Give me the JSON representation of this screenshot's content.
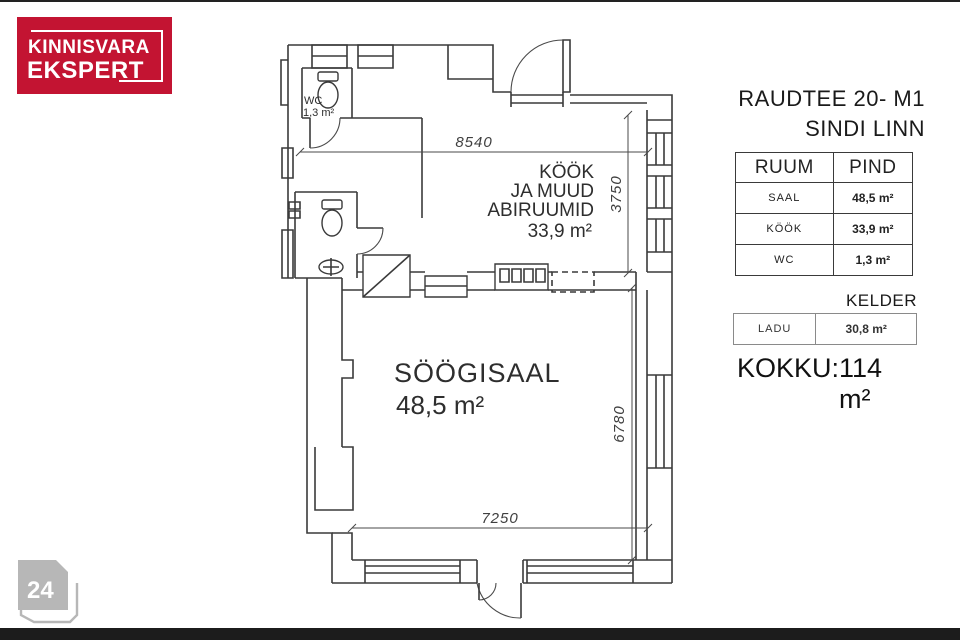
{
  "page": {
    "top_bar_color": "#222222",
    "bottom_bar_color": "#1c1c1c",
    "background": "#ffffff"
  },
  "logo": {
    "line1": "KINNISVARA",
    "line2": "EKSPERT",
    "bg_color": "#c31432",
    "text_color": "#ffffff"
  },
  "page_tag": {
    "number": "24",
    "color": "#b7b7b7"
  },
  "listing": {
    "title": "RAUDTEE 20- M1",
    "subtitle": "SINDI LINN"
  },
  "area_table": {
    "col_room": "RUUM",
    "col_area": "PIND",
    "rows": [
      {
        "room": "SAAL",
        "area": "48,5 m²"
      },
      {
        "room": "KÖÖK",
        "area": "33,9 m²"
      },
      {
        "room": "WC",
        "area": "1,3 m²"
      }
    ]
  },
  "basement": {
    "title": "KELDER",
    "rows": [
      {
        "room": "LADU",
        "area": "30,8 m²"
      }
    ]
  },
  "total": {
    "label": "KOKKU:",
    "value": "114 m²"
  },
  "floor_plan": {
    "rooms": {
      "kitchen": {
        "line1": "KÖÖK",
        "line2": "JA MUUD",
        "line3": "ABIRUUMID",
        "area": "33,9 m²"
      },
      "dining": {
        "name": "SÖÖGISAAL",
        "area": "48,5 m²"
      },
      "wc": {
        "name": "WC",
        "area": "1,3 m²"
      }
    },
    "dimensions": {
      "top": "8540",
      "right_upper": "3750",
      "right_lower": "6780",
      "bottom": "7250"
    }
  }
}
